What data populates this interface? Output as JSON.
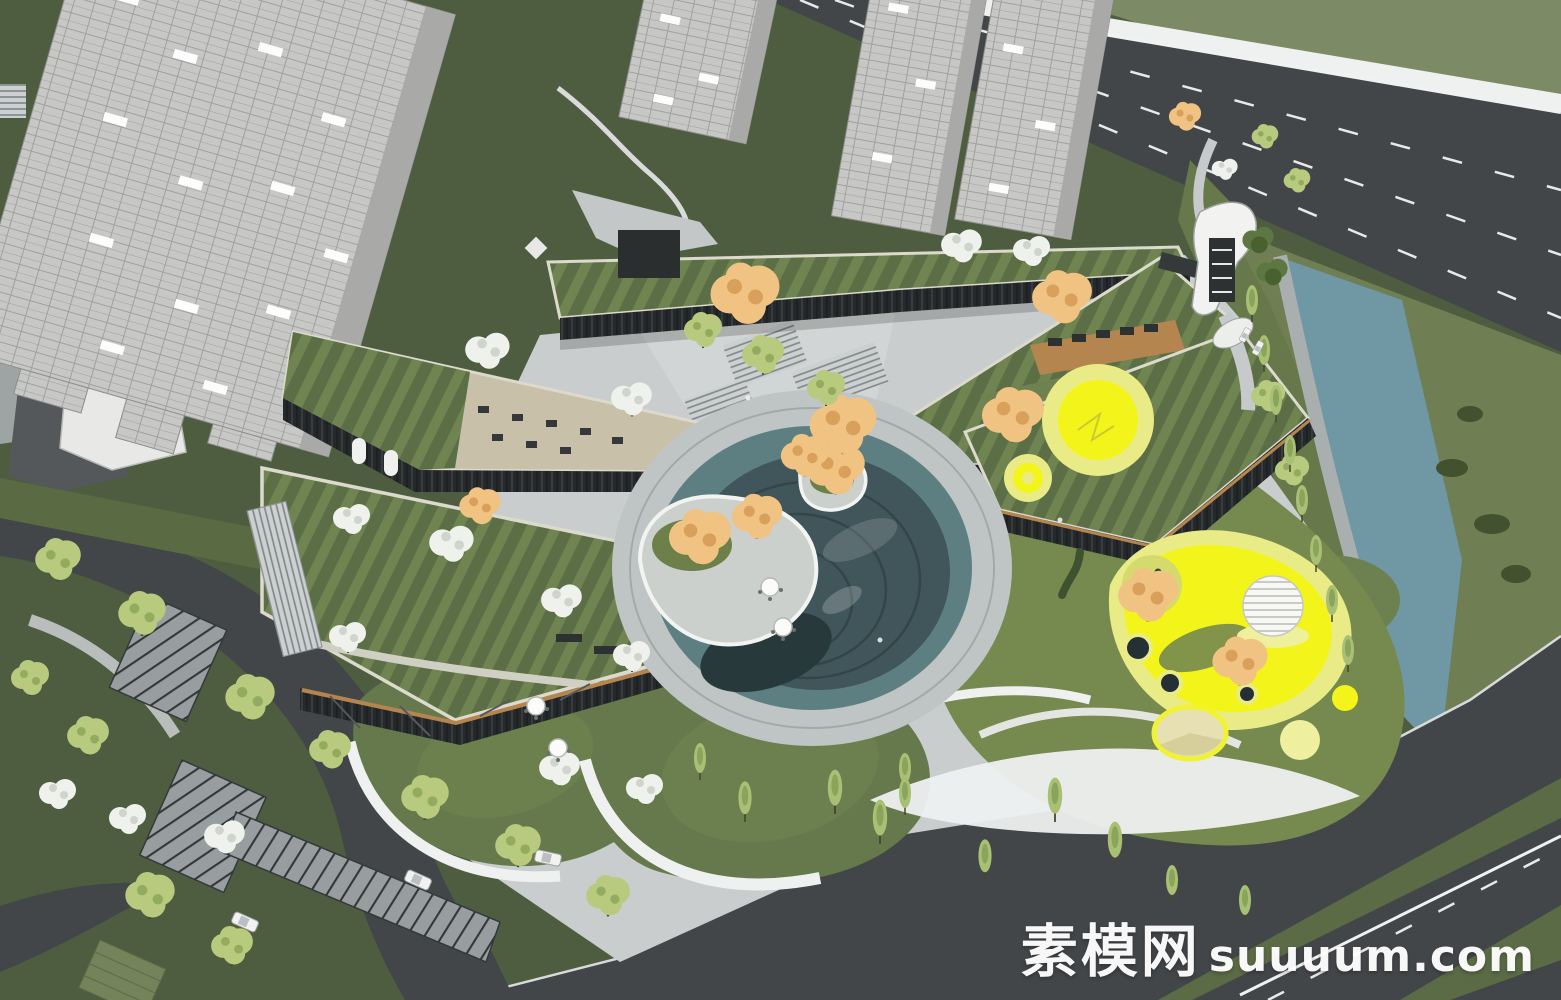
{
  "watermark": {
    "cjk": "素模网",
    "latin": "suuuum.com"
  },
  "palette": {
    "grass-dark": "#4e5d40",
    "grass-mid": "#66794c",
    "lawn-bright": "#76894f",
    "hill": "#7d8a66",
    "road": "#434649",
    "paving": "#c9cdce",
    "paving-light": "#e9ebeb",
    "water": "#6f98a4",
    "bank-green": "#6f7e53",
    "median-green": "#5b6b46",
    "roof-green": "#5c6e45",
    "roof-green-light": "#708452",
    "parapet": "#dcd9cd",
    "glazing": "#26292b",
    "wood": "#b5854f",
    "tower-light": "#c7c8c6",
    "tower-shade": "#a9aaa8",
    "dome-teal": "#41565a",
    "pond-teal": "#5e7f82",
    "pit-dark": "#27393b",
    "play-yellow": "#f3f41a",
    "play-yellow-pale": "#e9ec86",
    "tree-orange": "#f0c382",
    "tree-green": "#b7ca7d",
    "tree-blossom": "#eff1ec",
    "tree-dark": "#5d7742",
    "white": "#f4f5f3"
  }
}
